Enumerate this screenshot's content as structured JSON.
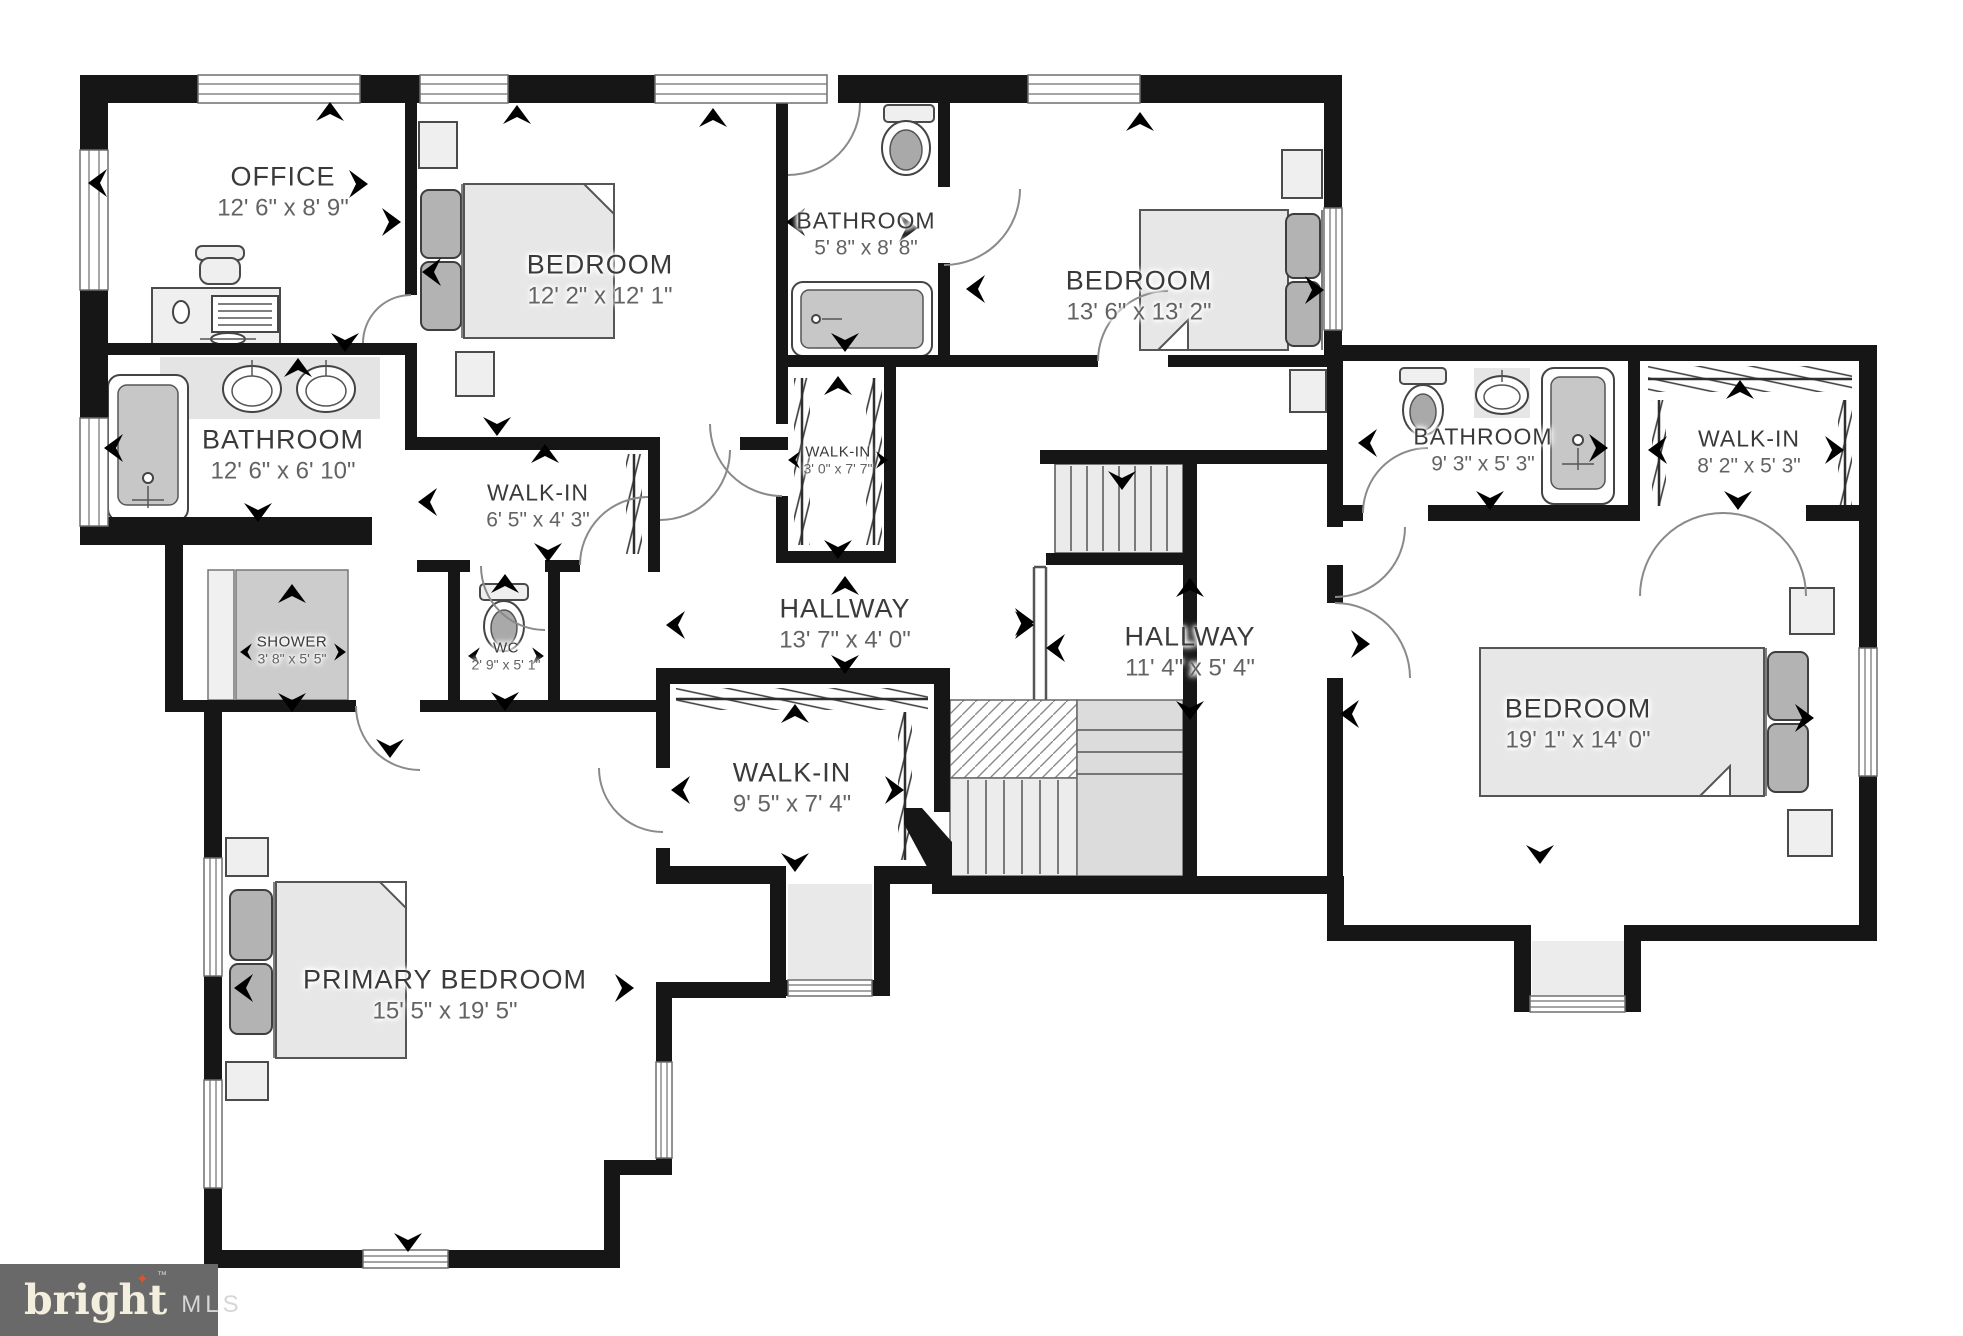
{
  "branding": {
    "logo_text": "bright",
    "spark": "✦",
    "tm": "™",
    "logo_suffix": "MLS",
    "logo_bg": "#696969",
    "logo_text_color": "#f3eedd",
    "spark_color": "#d9562c",
    "mls_color": "#d6d6d6"
  },
  "colors": {
    "wall": "#161616",
    "floor": "#ffffff",
    "furniture_fill": "#efefef",
    "pillow_fill": "#b3b3b3",
    "tub_fill": "#c7c7c7",
    "label_name": "#3a3a3a",
    "label_dims": "#636363"
  },
  "rooms": [
    {
      "id": "office",
      "name": "OFFICE",
      "dims": "12' 6\" x 8' 9\""
    },
    {
      "id": "bedroom-front",
      "name": "BEDROOM",
      "dims": "12' 2\" x 12' 1\""
    },
    {
      "id": "bathroom-top",
      "name": "BATHROOM",
      "dims": "5' 8\" x 8' 8\""
    },
    {
      "id": "bedroom-top-right",
      "name": "BEDROOM",
      "dims": "13' 6\" x 13' 2\""
    },
    {
      "id": "bathroom-left",
      "name": "BATHROOM",
      "dims": "12' 6\" x 6' 10\""
    },
    {
      "id": "walkin-65",
      "name": "WALK-IN",
      "dims": "6' 5\" x 4' 3\""
    },
    {
      "id": "walkin-30",
      "name": "WALK-IN",
      "dims": "3' 0\" x 7' 7\""
    },
    {
      "id": "bathroom-right",
      "name": "BATHROOM",
      "dims": "9' 3\" x 5' 3\""
    },
    {
      "id": "walkin-82",
      "name": "WALK-IN",
      "dims": "8' 2\" x 5' 3\""
    },
    {
      "id": "shower",
      "name": "SHOWER",
      "dims": "3' 8\" x 5' 5\""
    },
    {
      "id": "wc",
      "name": "WC",
      "dims": "2' 9\" x 5' 1\""
    },
    {
      "id": "hallway-main",
      "name": "HALLWAY",
      "dims": "13' 7\" x 4' 0\""
    },
    {
      "id": "hallway-right",
      "name": "HALLWAY",
      "dims": "11' 4\" x 5' 4\""
    },
    {
      "id": "walkin-95",
      "name": "WALK-IN",
      "dims": "9' 5\" x 7' 4\""
    },
    {
      "id": "primary-bedroom",
      "name": "PRIMARY BEDROOM",
      "dims": "15' 5\" x 19' 5\""
    },
    {
      "id": "bedroom-large",
      "name": "BEDROOM",
      "dims": "19' 1\" x 14' 0\""
    }
  ]
}
